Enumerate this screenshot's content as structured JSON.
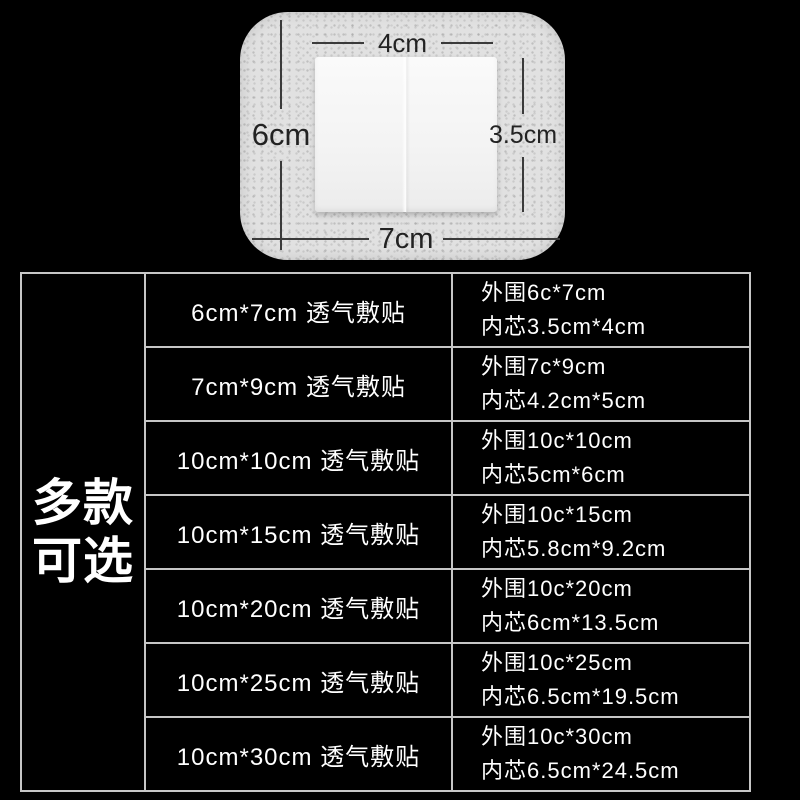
{
  "colors": {
    "background": "#000000",
    "table_border": "#c6c6c6",
    "table_text": "#ffffff",
    "dressing_base": "#e1e1e1",
    "pad_white": "#f4f4f4",
    "dimension_ink": "#2e2e2e"
  },
  "diagram": {
    "top_label": "4cm",
    "left_label": "6cm",
    "right_label": "3.5cm",
    "bottom_label": "7cm"
  },
  "side_banner": {
    "line1": "多款",
    "line2": "可选"
  },
  "table": {
    "rows": [
      {
        "spec": "6cm*7cm 透气敷贴",
        "outer": "外围6c*7cm",
        "inner": "内芯3.5cm*4cm"
      },
      {
        "spec": "7cm*9cm 透气敷贴",
        "outer": "外围7c*9cm",
        "inner": "内芯4.2cm*5cm"
      },
      {
        "spec": "10cm*10cm 透气敷贴",
        "outer": "外围10c*10cm",
        "inner": "内芯5cm*6cm"
      },
      {
        "spec": "10cm*15cm 透气敷贴",
        "outer": "外围10c*15cm",
        "inner": "内芯5.8cm*9.2cm"
      },
      {
        "spec": "10cm*20cm 透气敷贴",
        "outer": "外围10c*20cm",
        "inner": "内芯6cm*13.5cm"
      },
      {
        "spec": "10cm*25cm 透气敷贴",
        "outer": "外围10c*25cm",
        "inner": "内芯6.5cm*19.5cm"
      },
      {
        "spec": "10cm*30cm 透气敷贴",
        "outer": "外围10c*30cm",
        "inner": "内芯6.5cm*24.5cm"
      }
    ]
  }
}
